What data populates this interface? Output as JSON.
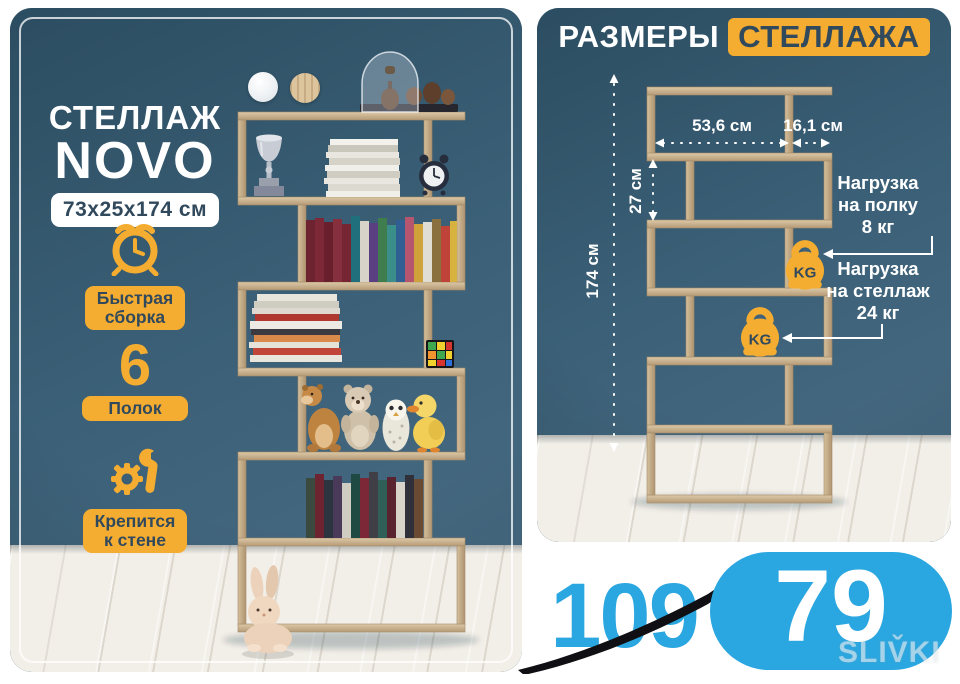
{
  "left_panel": {
    "title_line1": "СТЕЛЛАЖ",
    "title_line2": "NOVO",
    "size_badge": "73x25x174 см",
    "swatches": [
      {
        "name": "white"
      },
      {
        "name": "oak"
      }
    ],
    "features": [
      {
        "icon": "alarm-clock",
        "lines": [
          "Быстрая",
          "сборка"
        ]
      },
      {
        "count": "6",
        "lines": [
          "Полок"
        ]
      },
      {
        "icon": "gear-wrench",
        "lines": [
          "Крепится",
          "к стене"
        ]
      }
    ]
  },
  "right_panel": {
    "title_plain": "РАЗМЕРЫ",
    "title_highlight": "СТЕЛЛАЖА",
    "dimensions": {
      "total_height": "174 см",
      "shelf_width": "53,6 см",
      "side_width": "16,1 см",
      "cell_height": "27 см"
    },
    "loads": {
      "kg_badge": "KG",
      "per_shelf_lines": [
        "Нагрузка",
        "на полку",
        "8 кг"
      ],
      "total_lines": [
        "Нагрузка",
        "на стеллаж",
        "24 кг"
      ]
    }
  },
  "price": {
    "old": "109",
    "new": "79"
  },
  "watermark": "SLIV̌KI",
  "colors": {
    "accent_yellow": "#f5ad31",
    "wall_blue": "#3a5f76",
    "price_blue": "#2aa7e0",
    "text_navy": "#31495c",
    "wood": "#c9b190"
  }
}
